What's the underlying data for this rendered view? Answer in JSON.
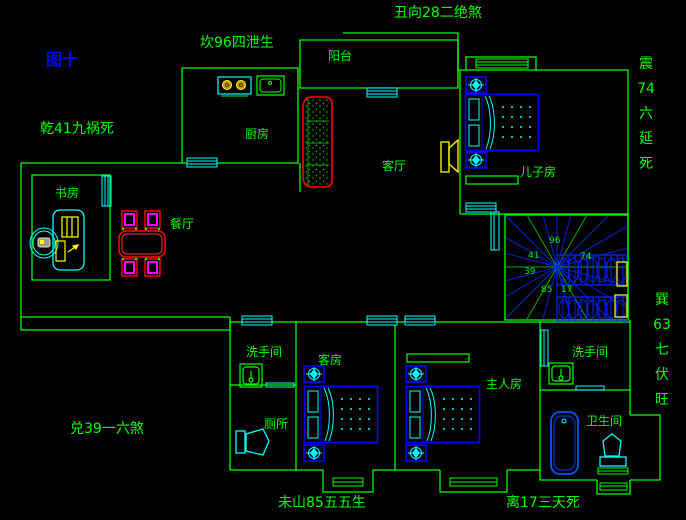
{
  "figure_title": "图十",
  "fengshui": {
    "top_center": "坎96四泄生",
    "top_right": "丑向28二绝煞",
    "west_upper": "乾41九祸死",
    "west_lower": "兑39一六煞",
    "east_upper": "震\n74\n六\n延\n死",
    "east_lower": "巽\n63\n七\n伏\n旺",
    "south_left": "未山85五五生",
    "south_right": "离17三天死"
  },
  "rooms": {
    "balcony": "阳台",
    "kitchen": "厨房",
    "living_room": "客厅",
    "dining_room": "餐厅",
    "study": "书房",
    "sons_room": "儿子房",
    "washroom_left": "洗手间",
    "toilet_room": "厕所",
    "guest_room": "客房",
    "master_room": "主人房",
    "washroom_right": "洗手间",
    "bathroom": "卫生间"
  },
  "stair_numbers": {
    "n96": "96",
    "n41": "41",
    "n74": "74",
    "n39": "39",
    "n85": "85",
    "n17": "17"
  },
  "colors": {
    "wall": "#00ff00",
    "text": "#00ff00",
    "title_blue": "#0000ff",
    "window_cyan": "#00ffff",
    "bed_blue": "#0000ff",
    "sofa_red": "#ff0000",
    "chair_magenta": "#ff00ff",
    "device_yellow": "#ffff00",
    "stair_blue": "#0022dd"
  }
}
